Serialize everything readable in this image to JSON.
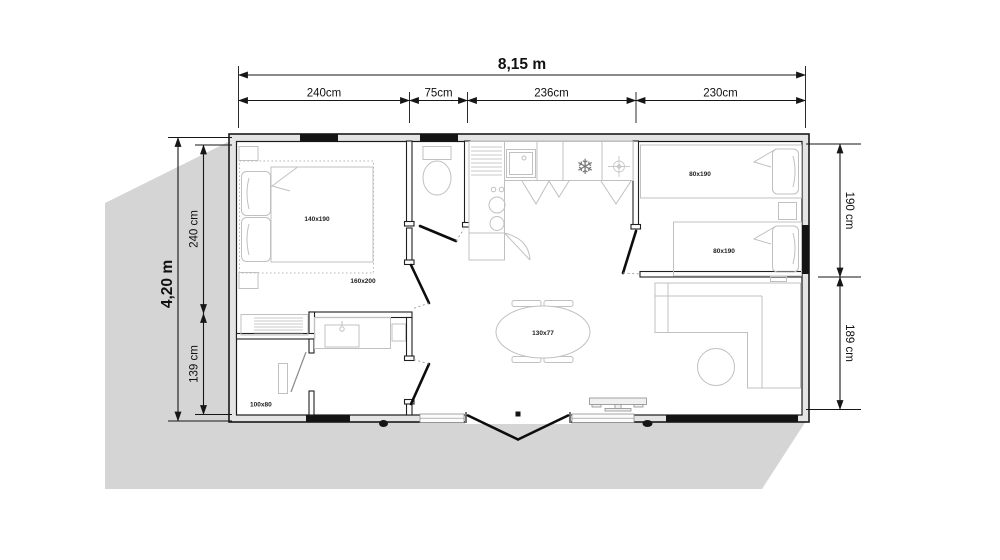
{
  "dimensions": {
    "top_total": "8,15 m",
    "top_segments": [
      "240cm",
      "75cm",
      "236cm",
      "230cm"
    ],
    "left_total": "4,20 m",
    "left_segments": [
      "240 cm",
      "139 cm"
    ],
    "right_segments": [
      "190 cm",
      "189 cm"
    ]
  },
  "labels": {
    "master_bed": "140x190",
    "master_bed_option": "160x200",
    "shower": "100x80",
    "dining_table": "130x77",
    "single_bed_1": "80x190",
    "single_bed_2": "80x190"
  },
  "icons": {
    "fridge_snowflake": "❄"
  },
  "colors": {
    "wall": "#1a1a1a",
    "furniture_line": "#c0c0c0",
    "terrace": "#d5d5d5",
    "window": "#141414"
  }
}
